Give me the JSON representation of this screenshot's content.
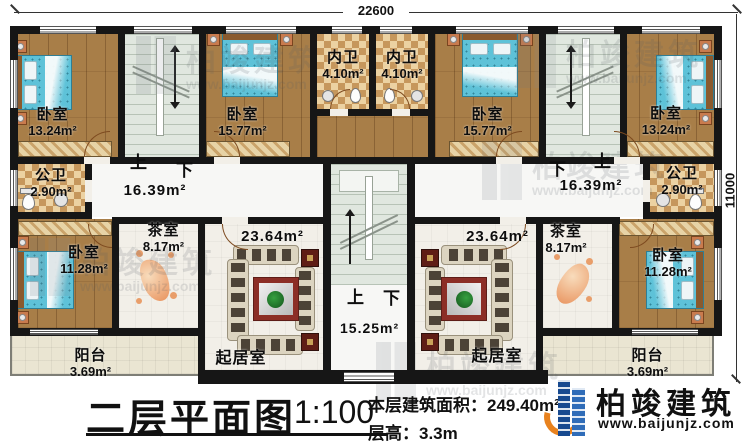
{
  "dimensions": {
    "top_width": "22600",
    "right_height": "11000"
  },
  "stairs": {
    "up": "上",
    "down": "下"
  },
  "rooms": {
    "bedroom_top_left": {
      "name": "卧室",
      "area": "13.24m²"
    },
    "bedroom_top_left_2": {
      "name": "卧室",
      "area": "15.77m²"
    },
    "inner_bath_left": {
      "name": "内卫",
      "area": "4.10m²"
    },
    "inner_bath_right": {
      "name": "内卫",
      "area": "4.10m²"
    },
    "bedroom_top_right_2": {
      "name": "卧室",
      "area": "15.77m²"
    },
    "bedroom_top_right": {
      "name": "卧室",
      "area": "13.24m²"
    },
    "public_bath_left": {
      "name": "公卫",
      "area": "2.90m²"
    },
    "public_bath_right": {
      "name": "公卫",
      "area": "2.90m²"
    },
    "hall_left": {
      "area": "16.39m²"
    },
    "hall_right": {
      "area": "16.39m²"
    },
    "tea_room_left": {
      "name": "茶室",
      "area": "8.17m²"
    },
    "tea_room_right": {
      "name": "茶室",
      "area": "8.17m²"
    },
    "bedroom_bottom_left": {
      "name": "卧室",
      "area": "11.28m²"
    },
    "bedroom_bottom_right": {
      "name": "卧室",
      "area": "11.28m²"
    },
    "living_left": {
      "name": "起居室",
      "area": "23.64m²"
    },
    "living_right": {
      "name": "起居室",
      "area": "23.64m²"
    },
    "stair_hall_center": {
      "area": "15.25m²"
    },
    "balcony_left": {
      "name": "阳台",
      "area": "3.69m²"
    },
    "balcony_right": {
      "name": "阳台",
      "area": "3.69m²"
    }
  },
  "footer": {
    "title": "二层平面图",
    "scale": "1:100",
    "area_label": "本层建筑面积：",
    "area_value": "249.40m²",
    "floor_height_label": "层高：",
    "floor_height_value": "3.3m"
  },
  "brand": {
    "name": "柏竣建筑",
    "url": "www.baijunjz.com"
  },
  "watermark": {
    "name": "柏竣建筑",
    "url": "www.baijunjz.com"
  },
  "colors": {
    "wall": "#161616",
    "wood_floor": "#a87e48",
    "tile_light": "#ecd2a2",
    "tile_dark": "#c6975c",
    "stair_floor": "#e0e7df",
    "bed_blue": "#5ec2d8",
    "brand_blue": "#1c4f9c",
    "brand_orange": "#e8821e"
  }
}
